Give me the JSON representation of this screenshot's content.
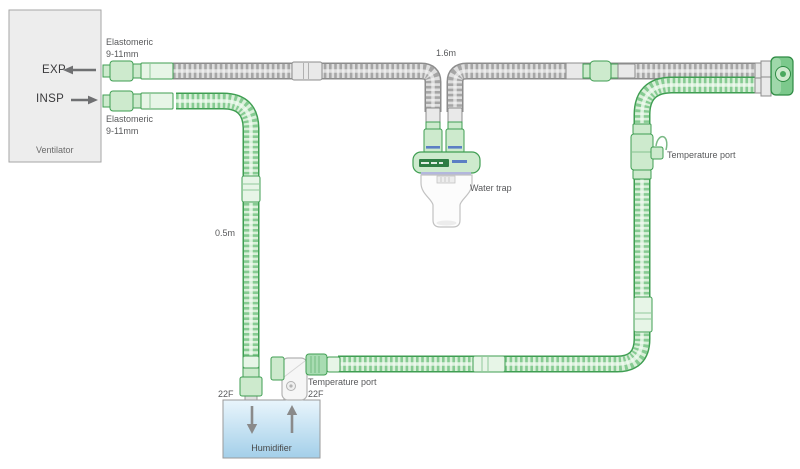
{
  "ventilator": {
    "label": "Ventilator",
    "exp_port": "EXP",
    "insp_port": "INSP"
  },
  "connectors": {
    "exp": {
      "line1": "Elastomeric",
      "line2": "9-11mm"
    },
    "insp": {
      "line1": "Elastomeric",
      "line2": "9-11mm"
    }
  },
  "tubes": {
    "expiratory_length": "1.6m",
    "inspiratory_length": "0.5m"
  },
  "water_trap": {
    "label": "Water trap"
  },
  "temp_ports": {
    "patient_side": "Temperature port",
    "humidifier_side": "Temperature port",
    "humidifier_side_size": "22F"
  },
  "humidifier": {
    "label": "Humidifier",
    "inlet_size": "22F"
  },
  "colors": {
    "tube_green": "#3f9e52",
    "tube_gray": "#8c8c8c",
    "connector_fill": "#cdeacd",
    "humidifier_blue": "#a3cfe9",
    "label_text": "#58595b"
  }
}
